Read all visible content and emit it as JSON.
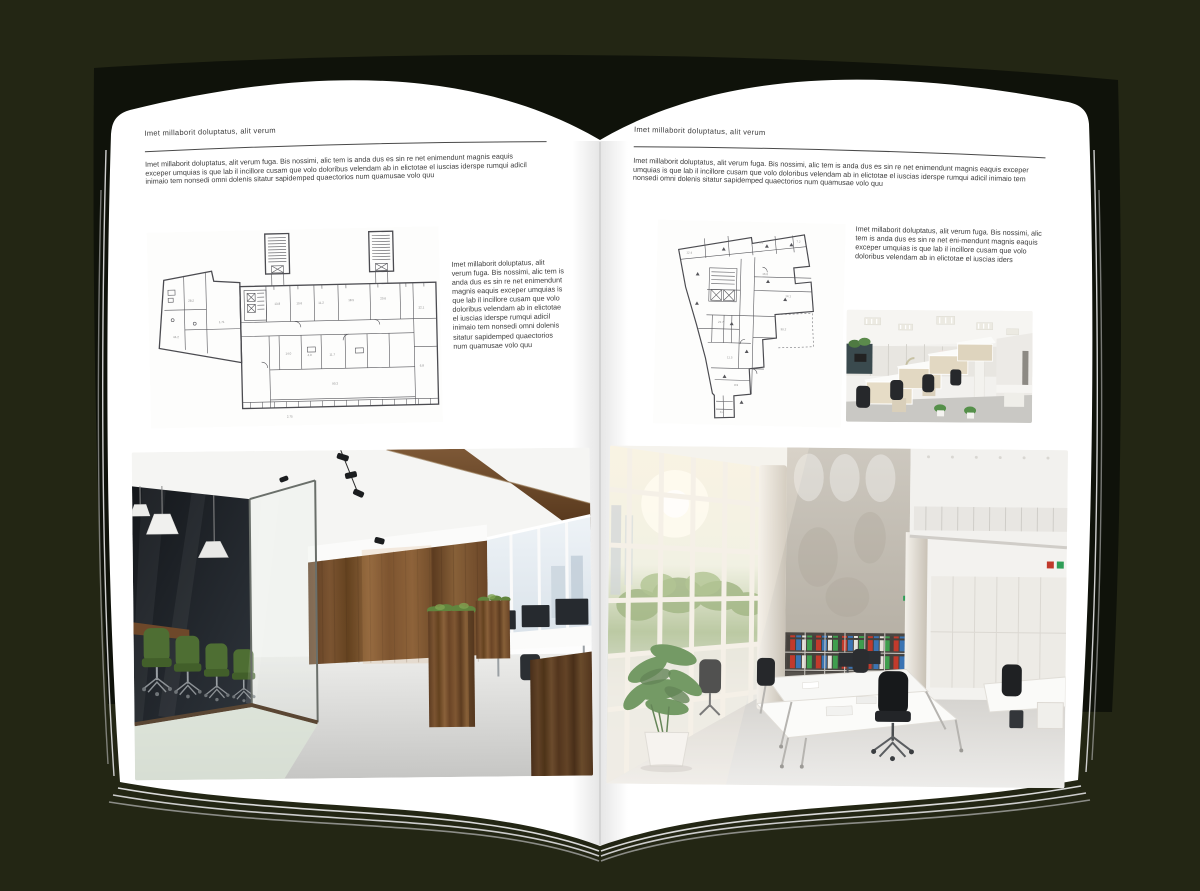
{
  "canvas": {
    "width": 1200,
    "height": 891,
    "background_color": "#232614"
  },
  "book": {
    "cover_color": "#0f120a",
    "page_color": "#ffffff",
    "spine_color": "#c8c8c8",
    "page_edge_color": "#d4d4d4"
  },
  "left_page": {
    "header": "Imet millaborit doluptatus, alit verum",
    "intro_paragraph": "Imet millaborit doluptatus, alit verum fuga. Bis nossimi, alic tem is anda dus es sin re net enimendunt magnis eaquis exceper umquias is que lab il incillore cusam que volo doloribus velendam ab in elictotae el iuscias iderspe rumqui adicil inimaio tem nonsedi omni dolenis sitatur sapidemped quaectorios num quamusae volo quu",
    "side_paragraph": "Imet millaborit doluptatus, alit verum fuga. Bis nossimi, alic tem is anda dus es sin re net enimendunt magnis eaquis exceper umquias is que lab il incillore cusam que volo doloribus velendam ab in elictotae el iuscias iderspe rumqui adicil inimaio tem nonsedi omni dolenis sitatur sapidemped quaectorios num quamusae volo quu",
    "figures": {
      "floor_plan": "wide-building-floor-plan-drawing",
      "photo": "loft-open-plan-office-photo"
    }
  },
  "right_page": {
    "header": "Imet millaborit doluptatus, alit verum",
    "intro_paragraph": "Imet millaborit doluptatus, alit verum fuga. Bis nossimi, alic tem is anda dus es sin re net enimendunt magnis eaquis exceper umquias is que lab il incillore cusam que volo doloribus velendam ab in elictotae el iuscias iderspe rumqui adicil inimaio tem nonsedi omni dolenis sitatur sapidemped quaectorios num quamusae volo quu",
    "side_paragraph": "Imet millaborit doluptatus, alit verum fuga. Bis nossimi, alic tem is anda dus es sin re net eni-mendunt magnis eaquis exceper umquias is que lab il incillore cusam que volo doloribus velendam ab in elictotae el iuscias iders",
    "figures": {
      "floor_plan": "irregular-tower-floor-plan-drawing",
      "photo_small": "cubicle-office-photo",
      "photo_large": "double-height-white-office-photo"
    }
  }
}
